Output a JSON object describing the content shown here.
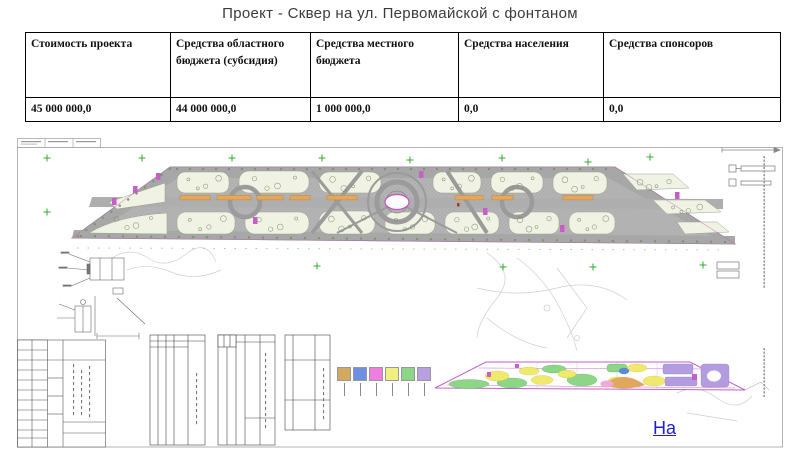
{
  "slide": {
    "title": "Проект  - Сквер на ул. Первомайской с  фонтаном"
  },
  "funding_table": {
    "columns": [
      {
        "header": "Стоимость проекта",
        "value": "45 000 000,0"
      },
      {
        "header": "Средства областного бюджета (субсидия)",
        "value": "44 000 000,0"
      },
      {
        "header": "Средства местного бюджета",
        "value": "1 000 000,0"
      },
      {
        "header": "Средства населения",
        "value": "0,0"
      },
      {
        "header": "Средства спонсоров",
        "value": "0,0"
      }
    ]
  },
  "link": {
    "label": "На"
  },
  "colors": {
    "link_blue": "#2121cb",
    "legend_swatches": [
      "#d2a95e",
      "#6f8fe0",
      "#ee7fe0",
      "#f3ee82",
      "#8ed687",
      "#b79fe0"
    ],
    "plan_path_gray": "#b4b4b4",
    "plan_planting_green": "#f0f3e3",
    "plan_accent_magenta": "#c85fc8",
    "plan_bench_orange": "#e2a95e",
    "survey_cross_green": "#2fae2f"
  }
}
